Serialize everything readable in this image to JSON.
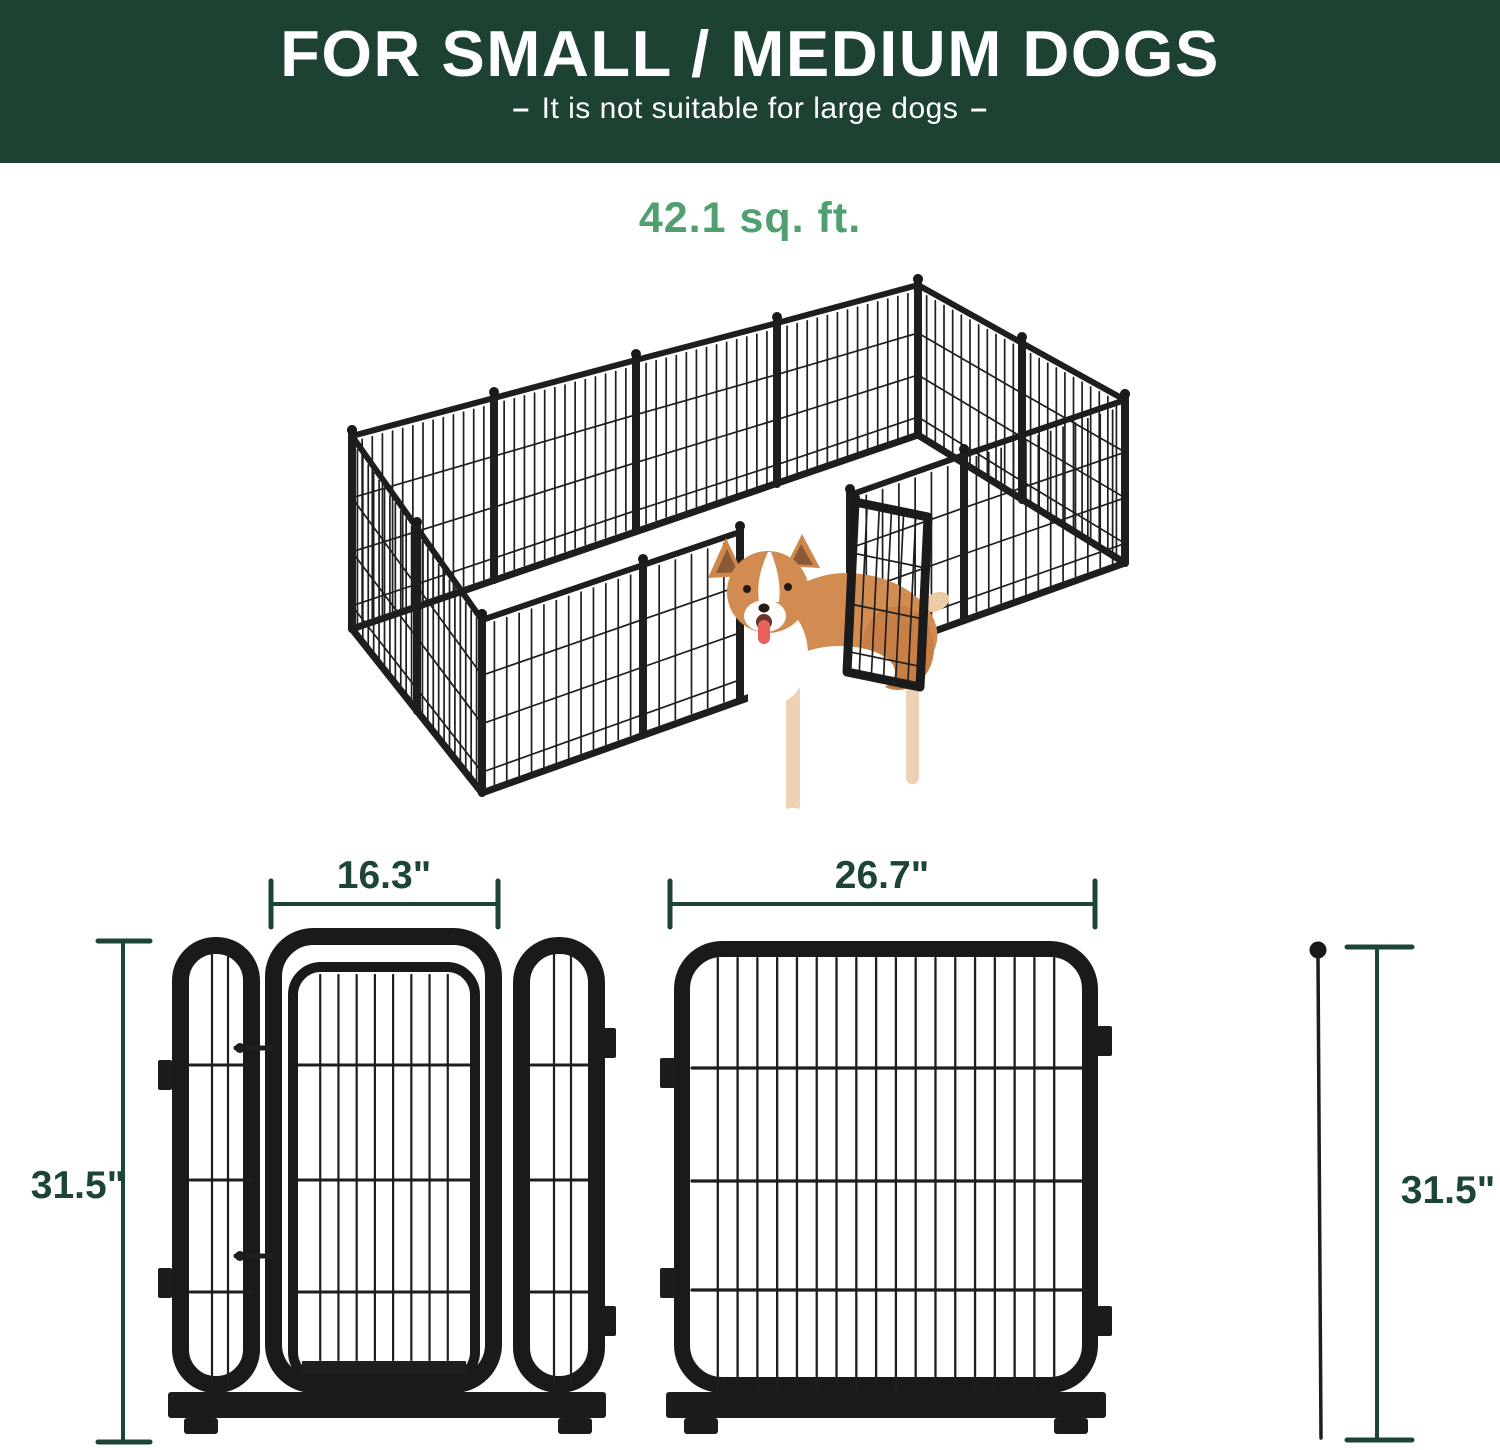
{
  "header": {
    "title": "FOR SMALL / MEDIUM DOGS",
    "dash_left": "–",
    "subtitle": "It is not suitable for large dogs",
    "dash_right": "–",
    "bg_color": "#1d4231",
    "text_color": "#ffffff"
  },
  "area_badge": {
    "label": "42.1 sq. ft.",
    "color": "#4f9f70"
  },
  "illustration": {
    "name": "isometric-12-panel-dog-playpen-with-open-gate-and-corgi"
  },
  "dimensions": {
    "color": "#1d4536",
    "door_panel_width": "16.3\"",
    "panel_width": "26.7\"",
    "panel_height_left": "31.5\"",
    "panel_height_right": "31.5\""
  }
}
